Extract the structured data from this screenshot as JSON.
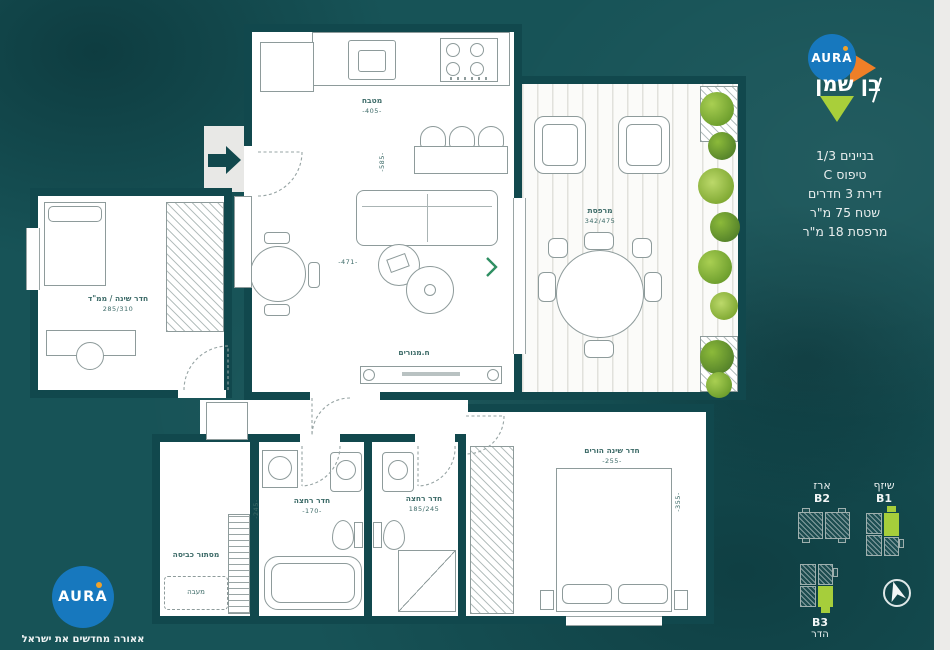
{
  "sidebar": {
    "brand": "AURA",
    "project": "בן שמן",
    "info_lines": [
      "בניינים 1/3",
      "טיפוס C",
      "דירת 3 חדרים",
      "שטח 75 מ\"ר",
      "מרפסת 18 מ\"ר"
    ],
    "keyplan": {
      "b2_name": "ארז",
      "b2_id": "B2",
      "b1_name": "שיזף",
      "b1_id": "B1",
      "b3_id": "B3",
      "b3_name": "הדר"
    }
  },
  "footer": {
    "brand": "AURA",
    "tagline": "אאורה מחדשים את ישראל"
  },
  "plan": {
    "kitchen": {
      "label": "מטבח",
      "dim": "-405-"
    },
    "living": {
      "label": "ח.מגורים",
      "dim_w": "-471-",
      "dim_h": "-585-"
    },
    "balcony": {
      "label": "מרפסת",
      "dim": "342/475"
    },
    "mamad": {
      "label": "חדר שינה / ממ\"ד",
      "dim": "285/310"
    },
    "bath1": {
      "label": "חדר רחצה",
      "dim": "-170-",
      "dim_v": "-245-"
    },
    "bath2": {
      "label": "חדר רחצה",
      "dim": "185/245"
    },
    "master": {
      "label": "חדר שינה הורים",
      "dim": "-255-",
      "dim_v": "-355-"
    },
    "laundry": {
      "label": "מסתור כביסה",
      "condenser": "מעבה"
    }
  },
  "colors": {
    "teal_bg": "#175357",
    "wall": "#11484d",
    "aura_blue": "#1778be",
    "accent_orange": "#ef7f27",
    "accent_green": "#a9cf3a"
  }
}
